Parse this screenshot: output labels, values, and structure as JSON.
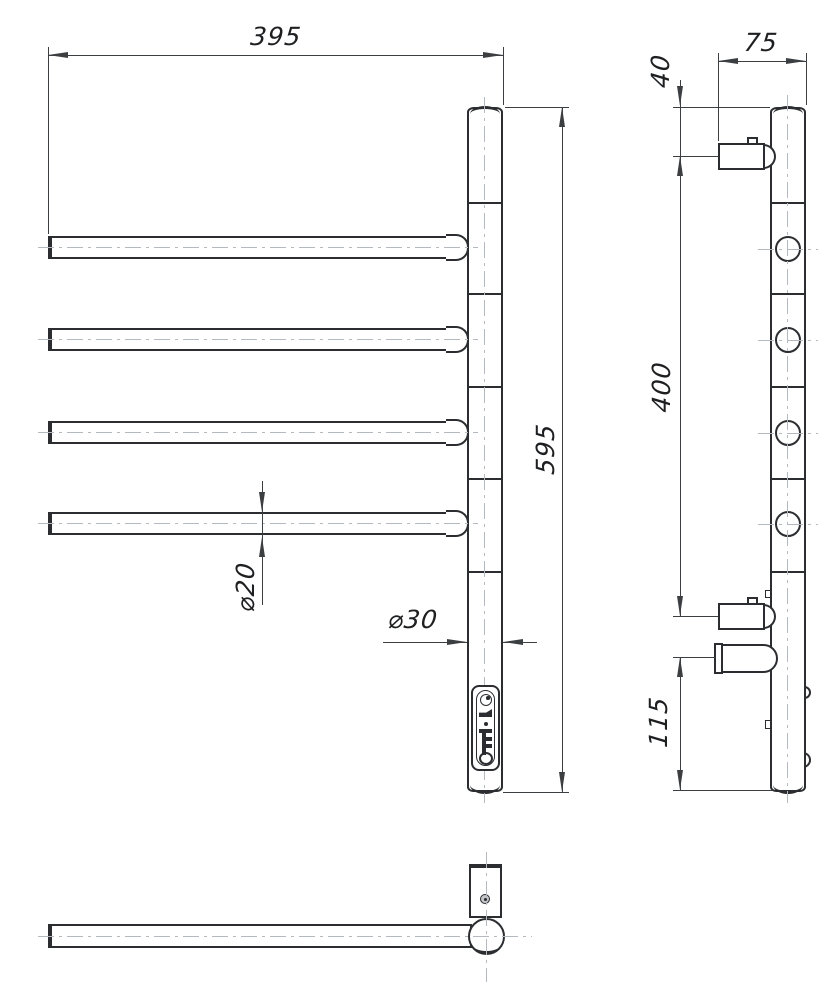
{
  "page": {
    "background": "#ffffff",
    "line_color": "#2b2d30",
    "dimension_color": "#3c3f42",
    "centerline_color": "#b3b9be",
    "units": "mm"
  },
  "views": {
    "front": "front-view",
    "side": "side-view",
    "bottom": "bottom-view"
  },
  "labels": {
    "overall_width": "395",
    "overall_height": "595",
    "arm_diameter": "⌀20",
    "post_diameter": "⌀30",
    "side_depth": "75",
    "top_bracket_offset": "40",
    "bracket_span": "400",
    "bottom_offset": "115"
  }
}
